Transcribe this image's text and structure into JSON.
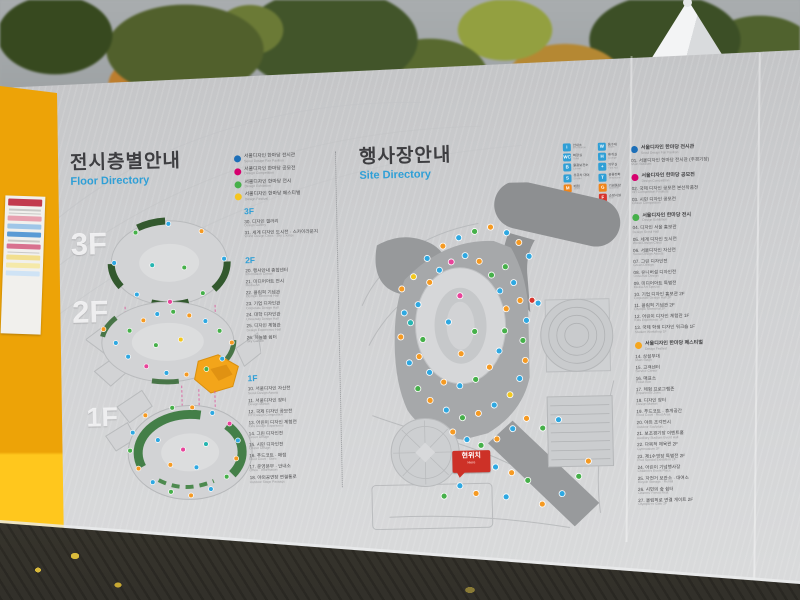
{
  "left_panel": {
    "title": "전시층별안내",
    "subtitle": "Floor Directory",
    "floor_marks": [
      "3F",
      "2F",
      "1F"
    ],
    "legend": [
      {
        "color": "#1d6fb8",
        "label": "서울디자인 한마당 전시관",
        "sub": "Seoul Design Fair Pavilion"
      },
      {
        "color": "#d6006e",
        "label": "서울디자인 한마당 공모전",
        "sub": "Design Competition"
      },
      {
        "color": "#46b04a",
        "label": "서울디자인 한마당 전시",
        "sub": "Design Exhibition"
      },
      {
        "color": "#f5c51f",
        "label": "서울디자인 한마당 페스티벌",
        "sub": "Design Festival"
      }
    ],
    "sections": [
      {
        "label": "3F",
        "items": [
          {
            "no": "30",
            "ko": "디자인 갤러리",
            "en": "Design Gallery"
          },
          {
            "no": "31",
            "ko": "세계 디자인 도시전 · 스카이라운지",
            "en": "World Design Cities · Sky Lounge"
          }
        ]
      },
      {
        "label": "2F",
        "items": [
          {
            "no": "20",
            "ko": "행사안내 종합센터",
            "en": "Information Center"
          },
          {
            "no": "21",
            "ko": "미디어아트 전시",
            "en": "Media Art"
          },
          {
            "no": "22",
            "ko": "올림픽 기념관",
            "en": "Olympic Memorial Hall"
          },
          {
            "no": "23",
            "ko": "기업 디자인관",
            "en": "Corporate Design Hall"
          },
          {
            "no": "24",
            "ko": "대학 디자인관",
            "en": "University Design Hall"
          },
          {
            "no": "25",
            "ko": "디자인 체험관",
            "en": "Design Experience Hall"
          },
          {
            "no": "26",
            "ko": "하늘뜰 쉼터",
            "en": "Sky Garden"
          }
        ]
      },
      {
        "label": "1F",
        "items": [
          {
            "no": "10",
            "ko": "서울디자인 자산전",
            "en": "Seoul Design Assets"
          },
          {
            "no": "11",
            "ko": "서울디자인 장터",
            "en": "Design Market"
          },
          {
            "no": "12",
            "ko": "국제 디자인 공모전",
            "en": "Int'l Design Competition"
          },
          {
            "no": "13",
            "ko": "어린이 디자인 체험전",
            "en": "Kids Design Experience"
          },
          {
            "no": "14",
            "ko": "그린 디자인전",
            "en": "Green Design"
          },
          {
            "no": "15",
            "ko": "시민 디자인전",
            "en": "Citizen Design"
          },
          {
            "no": "16",
            "ko": "푸드코트 · 매점",
            "en": "Food Court · Store"
          },
          {
            "no": "17",
            "ko": "운영본부 · 안내소",
            "en": "Office · Information"
          },
          {
            "no": "18",
            "ko": "야외공연장 연결통로",
            "en": "Outdoor Stage Passage"
          }
        ]
      }
    ]
  },
  "right_panel": {
    "title": "행사장안내",
    "subtitle": "Site Directory",
    "you_are_here": {
      "ko": "현위치",
      "en": "Here"
    },
    "facility_legend": {
      "columns": [
        [
          {
            "glyph": "i",
            "color": "#2f9fd6",
            "ko": "안내소",
            "en": "Information"
          },
          {
            "glyph": "WC",
            "color": "#2f9fd6",
            "ko": "화장실",
            "en": "Toilet"
          },
          {
            "glyph": "B",
            "color": "#2f9fd6",
            "ko": "물품보관소",
            "en": "Locker"
          },
          {
            "glyph": "S",
            "color": "#2f9fd6",
            "ko": "유모차 대여",
            "en": "Stroller"
          },
          {
            "glyph": "M",
            "color": "#f08519",
            "ko": "매점",
            "en": "Store"
          },
          {
            "glyph": "R",
            "color": "#f08519",
            "ko": "식당",
            "en": "Restaurant"
          }
        ],
        [
          {
            "glyph": "W",
            "color": "#2f9fd6",
            "ko": "음수대",
            "en": "Water"
          },
          {
            "glyph": "H",
            "color": "#2f9fd6",
            "ko": "휴게실",
            "en": "Lounge"
          },
          {
            "glyph": "+",
            "color": "#2f9fd6",
            "ko": "의무실",
            "en": "First Aid"
          },
          {
            "glyph": "T",
            "color": "#2f9fd6",
            "ko": "공중전화",
            "en": "Telephone"
          },
          {
            "glyph": "G",
            "color": "#f08519",
            "ko": "기념품샵",
            "en": "Souvenir"
          },
          {
            "glyph": "F",
            "color": "#d8342c",
            "ko": "소방시설",
            "en": "Fire"
          }
        ]
      ]
    },
    "sections": [
      {
        "color": "#1d6fb8",
        "label": "서울디자인 한마당 전시관",
        "sub": "Seoul Design Fair Pavilion",
        "items": [
          {
            "no": "01",
            "ko": "서울디자인 한마당 전시관 (주경기장)",
            "en": "Main Stadium"
          }
        ]
      },
      {
        "color": "#d6006e",
        "label": "서울디자인 한마당 공모전",
        "sub": "Design Competition",
        "items": [
          {
            "no": "02",
            "ko": "국제 디자인 공모전 본선작품전",
            "en": "Int'l Competition Finalists"
          },
          {
            "no": "03",
            "ko": "시민 디자인 공모전",
            "en": "Citizen Competition"
          }
        ]
      },
      {
        "color": "#46b04a",
        "label": "서울디자인 한마당 전시",
        "sub": "Design Exhibition",
        "items": [
          {
            "no": "04",
            "ko": "디자인 서울 홍보관",
            "en": "Design Seoul Hall"
          },
          {
            "no": "05",
            "ko": "세계 디자인 도시전",
            "en": "World Design Cities"
          },
          {
            "no": "06",
            "ko": "서울디자인 자산전",
            "en": "Seoul Design Assets"
          },
          {
            "no": "07",
            "ko": "그린 디자인전",
            "en": "Green Design"
          },
          {
            "no": "08",
            "ko": "유니버설 디자인전",
            "en": "Universal Design"
          },
          {
            "no": "09",
            "ko": "미디어아트 특별전",
            "en": "Media Art Special"
          },
          {
            "no": "10",
            "ko": "기업 디자인 홍보관 2F",
            "en": "Corporate Design Hall 2F"
          },
          {
            "no": "11",
            "ko": "올림픽 기념관 2F",
            "en": "Olympic Memorial 2F"
          },
          {
            "no": "12",
            "ko": "어린이 디자인 체험관 1F",
            "en": "Kids Experience 1F"
          },
          {
            "no": "13",
            "ko": "국제 학생 디자인 워크숍 1F",
            "en": "Student Workshop 1F"
          }
        ]
      },
      {
        "color": "#f5a61f",
        "label": "서울디자인 한마당 페스티벌",
        "sub": "Design Festival",
        "items": [
          {
            "no": "14",
            "ko": "상설무대",
            "en": "Main Stage"
          },
          {
            "no": "15",
            "ko": "고객센터",
            "en": "Service Center"
          },
          {
            "no": "16",
            "ko": "매표소",
            "en": "Ticket Box"
          },
          {
            "no": "17",
            "ko": "체험 프로그램존",
            "en": "Experience Zone"
          },
          {
            "no": "18",
            "ko": "디자인 장터",
            "en": "Design Market"
          },
          {
            "no": "19",
            "ko": "푸드코트 · 휴게공간",
            "en": "Food Court · Rest Area"
          },
          {
            "no": "20",
            "ko": "야외 조각전시",
            "en": "Outdoor Sculpture"
          },
          {
            "no": "21",
            "ko": "보조경기장 이벤트홀",
            "en": "Auxiliary Stadium Event Hall"
          },
          {
            "no": "22",
            "ko": "다목적 체육관 2F",
            "en": "Gymnasium 2F"
          },
          {
            "no": "23",
            "ko": "제1수영장 특별전 2F",
            "en": "Pool Special Exhibition 2F"
          },
          {
            "no": "24",
            "ko": "어린이 기념행사장",
            "en": "Children's Event Place"
          },
          {
            "no": "25",
            "ko": "자전거 보관소 · 대여소",
            "en": "Bicycle Storage · Rental"
          },
          {
            "no": "26",
            "ko": "시민의 숲 쉼터",
            "en": "Citizens' Forest Rest"
          },
          {
            "no": "27",
            "ko": "올림픽로 연결 게이트 2F",
            "en": "Olympic-ro Gate 2F"
          }
        ]
      }
    ]
  },
  "site_map": {
    "palette": {
      "b": "#2fa8e1",
      "o": "#f59a23",
      "g": "#46b04a",
      "p": "#e8439a",
      "r": "#d8342c",
      "y": "#f2c71d",
      "t": "#26b5b0"
    },
    "markers": [
      [
        58,
        120,
        "b"
      ],
      [
        50,
        138,
        "t"
      ],
      [
        62,
        155,
        "g"
      ],
      [
        70,
        98,
        "o"
      ],
      [
        80,
        86,
        "b"
      ],
      [
        92,
        78,
        "p"
      ],
      [
        106,
        72,
        "b"
      ],
      [
        120,
        78,
        "o"
      ],
      [
        132,
        92,
        "g"
      ],
      [
        140,
        108,
        "b"
      ],
      [
        146,
        126,
        "o"
      ],
      [
        144,
        148,
        "g"
      ],
      [
        138,
        168,
        "b"
      ],
      [
        128,
        184,
        "o"
      ],
      [
        114,
        196,
        "g"
      ],
      [
        98,
        202,
        "b"
      ],
      [
        82,
        198,
        "o"
      ],
      [
        68,
        188,
        "b"
      ],
      [
        58,
        172,
        "o"
      ],
      [
        100,
        112,
        "p"
      ],
      [
        88,
        138,
        "b"
      ],
      [
        114,
        148,
        "g"
      ],
      [
        100,
        170,
        "o"
      ],
      [
        44,
        128,
        "b"
      ],
      [
        40,
        152,
        "o"
      ],
      [
        48,
        178,
        "b"
      ],
      [
        56,
        204,
        "g"
      ],
      [
        68,
        216,
        "o"
      ],
      [
        84,
        226,
        "b"
      ],
      [
        100,
        234,
        "g"
      ],
      [
        116,
        230,
        "o"
      ],
      [
        132,
        222,
        "b"
      ],
      [
        148,
        212,
        "y"
      ],
      [
        158,
        196,
        "b"
      ],
      [
        164,
        178,
        "o"
      ],
      [
        162,
        158,
        "g"
      ],
      [
        166,
        138,
        "b"
      ],
      [
        160,
        118,
        "o"
      ],
      [
        154,
        100,
        "b"
      ],
      [
        146,
        84,
        "g"
      ],
      [
        42,
        104,
        "o"
      ],
      [
        54,
        92,
        "y"
      ],
      [
        68,
        74,
        "b"
      ],
      [
        84,
        62,
        "o"
      ],
      [
        100,
        54,
        "b"
      ],
      [
        116,
        48,
        "g"
      ],
      [
        132,
        44,
        "o"
      ],
      [
        148,
        50,
        "b"
      ],
      [
        160,
        60,
        "o"
      ],
      [
        170,
        74,
        "b"
      ],
      [
        172,
        118,
        "r"
      ],
      [
        178,
        121,
        "b"
      ],
      [
        90,
        248,
        "o"
      ],
      [
        104,
        256,
        "b"
      ],
      [
        118,
        262,
        "g"
      ],
      [
        134,
        256,
        "o"
      ],
      [
        150,
        246,
        "b"
      ],
      [
        164,
        236,
        "o"
      ],
      [
        180,
        246,
        "g"
      ],
      [
        196,
        238,
        "b"
      ],
      [
        118,
        276,
        "y"
      ],
      [
        132,
        284,
        "b"
      ],
      [
        148,
        290,
        "o"
      ],
      [
        164,
        298,
        "g"
      ],
      [
        96,
        302,
        "b"
      ],
      [
        112,
        310,
        "o"
      ],
      [
        80,
        312,
        "g"
      ],
      [
        142,
        314,
        "b"
      ],
      [
        178,
        322,
        "o"
      ],
      [
        198,
        312,
        "b"
      ],
      [
        215,
        295,
        "g"
      ],
      [
        225,
        280,
        "o"
      ]
    ]
  },
  "floor_diagram": {
    "dots": [
      [
        30,
        52,
        "b"
      ],
      [
        52,
        22,
        "g"
      ],
      [
        85,
        14,
        "b"
      ],
      [
        118,
        22,
        "o"
      ],
      [
        140,
        50,
        "b"
      ],
      [
        118,
        84,
        "g"
      ],
      [
        85,
        92,
        "p"
      ],
      [
        52,
        84,
        "b"
      ],
      [
        68,
        55,
        "t"
      ],
      [
        100,
        58,
        "g"
      ],
      [
        18,
        118,
        "o"
      ],
      [
        30,
        132,
        "b"
      ],
      [
        44,
        120,
        "g"
      ],
      [
        58,
        110,
        "o"
      ],
      [
        72,
        104,
        "b"
      ],
      [
        88,
        102,
        "g"
      ],
      [
        104,
        106,
        "o"
      ],
      [
        120,
        112,
        "b"
      ],
      [
        134,
        122,
        "g"
      ],
      [
        146,
        134,
        "o"
      ],
      [
        136,
        150,
        "b"
      ],
      [
        120,
        160,
        "g"
      ],
      [
        100,
        165,
        "o"
      ],
      [
        80,
        163,
        "b"
      ],
      [
        60,
        156,
        "p"
      ],
      [
        42,
        146,
        "b"
      ],
      [
        95,
        130,
        "y"
      ],
      [
        70,
        135,
        "g"
      ],
      [
        58,
        205,
        "o"
      ],
      [
        45,
        222,
        "b"
      ],
      [
        42,
        240,
        "g"
      ],
      [
        50,
        258,
        "o"
      ],
      [
        64,
        272,
        "b"
      ],
      [
        82,
        282,
        "g"
      ],
      [
        102,
        286,
        "o"
      ],
      [
        122,
        280,
        "b"
      ],
      [
        138,
        268,
        "g"
      ],
      [
        148,
        250,
        "o"
      ],
      [
        150,
        232,
        "b"
      ],
      [
        142,
        215,
        "p"
      ],
      [
        125,
        204,
        "b"
      ],
      [
        105,
        198,
        "o"
      ],
      [
        85,
        198,
        "g"
      ],
      [
        70,
        230,
        "b"
      ],
      [
        95,
        240,
        "p"
      ],
      [
        118,
        235,
        "t"
      ],
      [
        108,
        258,
        "b"
      ],
      [
        82,
        255,
        "o"
      ]
    ]
  }
}
